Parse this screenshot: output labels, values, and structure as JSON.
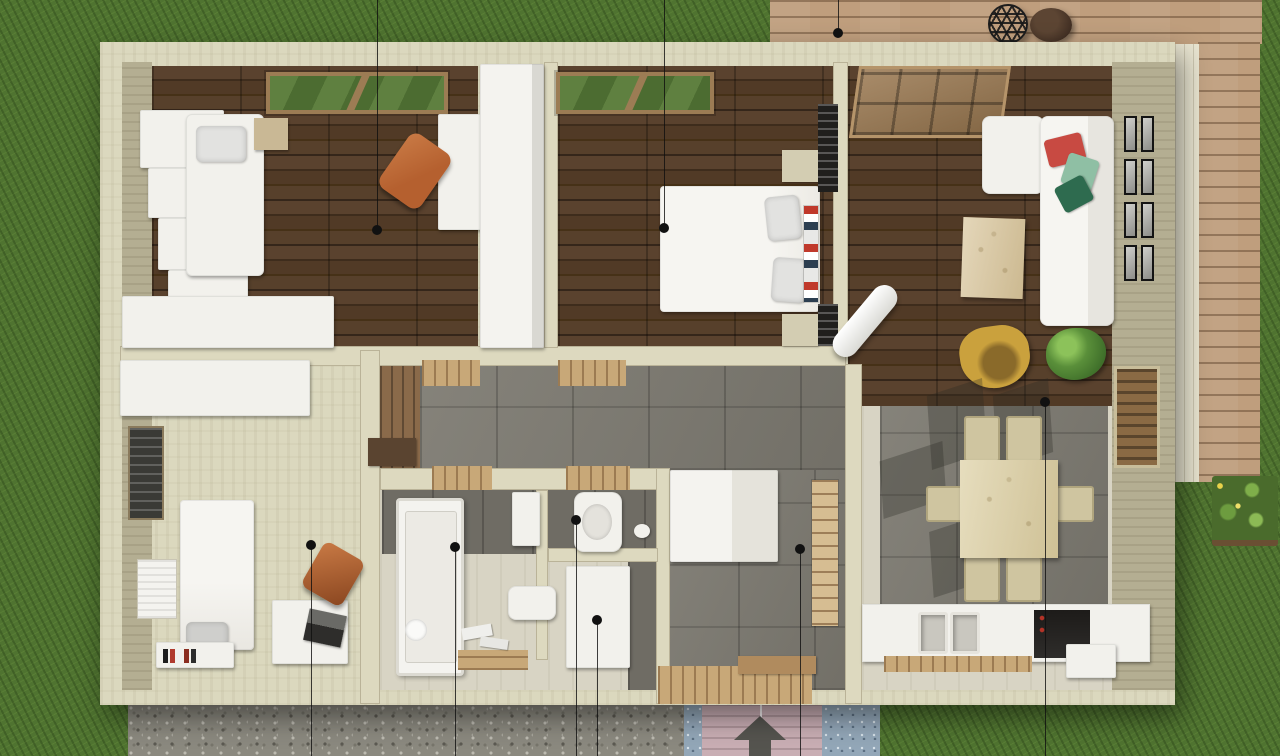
{
  "scene": {
    "kind": "3d-floor-plan-top-down-render",
    "entrance_arrow_direction": "up"
  },
  "colors": {
    "grass": "#4f7330",
    "deck": "#bf9e7d",
    "wall": "#dbd8be",
    "wood_floor": "#4e3826",
    "tile": "#7c7970",
    "floor_light": "#d8d4c4",
    "gravel": "#8b897f",
    "mat_pink": "#c9aeb4",
    "mat_blue": "#93a7b8",
    "accent_red": "#c84a42",
    "accent_green_light": "#8fbfa4",
    "accent_green_dark": "#2e6b4f",
    "accent_yellow": "#caa13d",
    "accent_orange": "#b5602f",
    "wood_light": "#c8a878",
    "frame_black": "#141414"
  },
  "markers": {
    "dots": [
      {
        "x": 377,
        "y": 230
      },
      {
        "x": 664,
        "y": 228
      },
      {
        "x": 838,
        "y": 33
      },
      {
        "x": 1045,
        "y": 402
      },
      {
        "x": 311,
        "y": 545
      },
      {
        "x": 455,
        "y": 547
      },
      {
        "x": 576,
        "y": 520
      },
      {
        "x": 597,
        "y": 620
      },
      {
        "x": 800,
        "y": 549
      }
    ],
    "lines": [
      {
        "x": 377,
        "y1": 0,
        "y2": 230
      },
      {
        "x": 664,
        "y1": 0,
        "y2": 228
      },
      {
        "x": 838,
        "y1": 0,
        "y2": 33
      },
      {
        "x": 311,
        "y1": 545,
        "y2": 756
      },
      {
        "x": 455,
        "y1": 547,
        "y2": 756
      },
      {
        "x": 576,
        "y1": 520,
        "y2": 756
      },
      {
        "x": 597,
        "y1": 620,
        "y2": 756
      },
      {
        "x": 800,
        "y1": 549,
        "y2": 756
      },
      {
        "x": 1045,
        "y1": 402,
        "y2": 756
      }
    ]
  }
}
